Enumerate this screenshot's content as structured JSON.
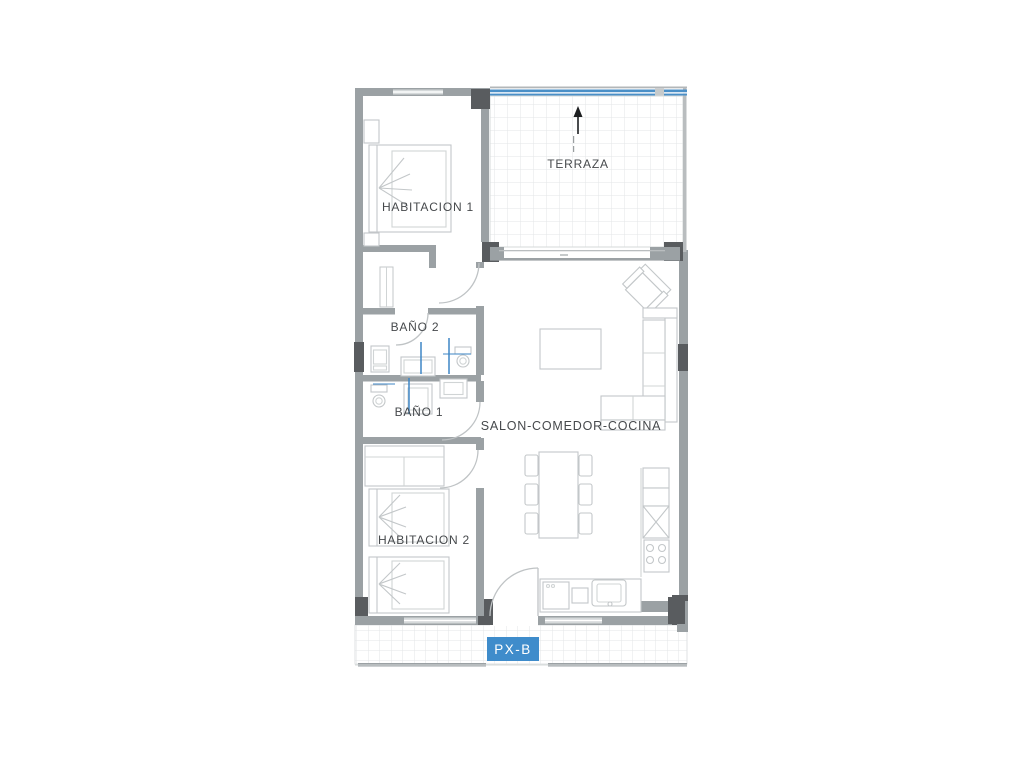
{
  "plan": {
    "unit_label": "PX-B",
    "rooms": [
      {
        "label": "HABITACION 1"
      },
      {
        "label": "TERRAZA"
      },
      {
        "label": "BAÑO 2"
      },
      {
        "label": "BAÑO 1"
      },
      {
        "label": "SALON-COMEDOR-COCINA"
      },
      {
        "label": "HABITACION 2"
      }
    ],
    "icons": {
      "north_arrow_icon": "↑"
    },
    "colors": {
      "wall_gray": "#9ba1a4",
      "wall_dark": "#595c5f",
      "window_gray": "#d5d9da",
      "furniture_line": "#c3c7c9",
      "tile_line": "#e3e6e7",
      "plumbing_blue": "#3d86c6",
      "railing_blue": "#4a8fc7",
      "unit_badge_bg": "#3f8ccb",
      "unit_badge_text": "#ffffff",
      "label_text": "#46494c",
      "background": "#ffffff"
    }
  }
}
